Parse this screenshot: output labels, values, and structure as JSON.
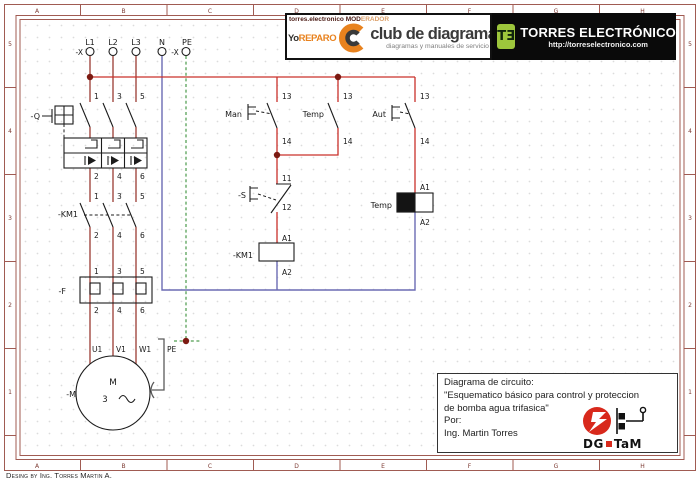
{
  "colors": {
    "phase_wire": "#9a3b33",
    "control_wire": "#c9312b",
    "neutral_wire": "#6b6bb4",
    "pe_wire": "#6fae6f",
    "junction_dot": "#7c1a12",
    "symbol_ink": "#1c1c1c",
    "frame_line": "#a05b52",
    "ruler_text": "#7d3b33",
    "grid_dot": "#d8d8d8",
    "brand_orange": "#e8821e",
    "logo_green": "#9dc63c",
    "logo_red": "#d8291c"
  },
  "ruler": {
    "cols": [
      "A",
      "B",
      "C",
      "D",
      "E",
      "F",
      "G",
      "H"
    ],
    "rows": [
      "5",
      "4",
      "3",
      "2",
      "1"
    ]
  },
  "header": {
    "left": {
      "line1_dark": "torres.electronico MOD",
      "line1_light": "ERADOR",
      "brand_dark": "Yo",
      "brand_orange": "REPARO",
      "title": "club de diagramas",
      "subtitle": "diagramas y manuales de servicio"
    },
    "right": {
      "logo": "TƎ",
      "title": "TORRES ELECTRÓNICO",
      "url": "http://torreselectronico.com"
    }
  },
  "title_block": {
    "lines": [
      "Diagrama de circuito:",
      "\"Esquematico básico para control y proteccion",
      "de bomba agua trifasica\"",
      "Por:",
      "Ing. Martin Torres"
    ],
    "logo_text_1": "DG",
    "logo_text_2": "TaM"
  },
  "footer": {
    "credit": "Desing by Ing. Torres Martin A."
  },
  "schematic": {
    "labels": [
      {
        "t": "L1",
        "x": 90,
        "y": 45,
        "a": "m",
        "s": 8
      },
      {
        "t": "L2",
        "x": 113,
        "y": 45,
        "a": "m",
        "s": 8
      },
      {
        "t": "L3",
        "x": 136,
        "y": 45,
        "a": "m",
        "s": 8
      },
      {
        "t": "N",
        "x": 162,
        "y": 45,
        "a": "m",
        "s": 8
      },
      {
        "t": "PE",
        "x": 187,
        "y": 45,
        "a": "m",
        "s": 8
      },
      {
        "t": "-X",
        "x": 83,
        "y": 55,
        "a": "e",
        "s": 7.5
      },
      {
        "t": "-X",
        "x": 175,
        "y": 55,
        "a": "m",
        "s": 7.5
      },
      {
        "t": "-Q",
        "x": 40,
        "y": 119,
        "a": "e",
        "s": 8
      },
      {
        "t": "1",
        "x": 94,
        "y": 99,
        "a": "s",
        "s": 7.5
      },
      {
        "t": "3",
        "x": 117,
        "y": 99,
        "a": "s",
        "s": 7.5
      },
      {
        "t": "5",
        "x": 140,
        "y": 99,
        "a": "s",
        "s": 7.5
      },
      {
        "t": "2",
        "x": 94,
        "y": 179,
        "a": "s",
        "s": 7.5
      },
      {
        "t": "4",
        "x": 117,
        "y": 179,
        "a": "s",
        "s": 7.5
      },
      {
        "t": "6",
        "x": 140,
        "y": 179,
        "a": "s",
        "s": 7.5
      },
      {
        "t": "1",
        "x": 94,
        "y": 199,
        "a": "s",
        "s": 7.5
      },
      {
        "t": "3",
        "x": 117,
        "y": 199,
        "a": "s",
        "s": 7.5
      },
      {
        "t": "5",
        "x": 140,
        "y": 199,
        "a": "s",
        "s": 7.5
      },
      {
        "t": "-KM1",
        "x": 78,
        "y": 217,
        "a": "e",
        "s": 8
      },
      {
        "t": "2",
        "x": 94,
        "y": 238,
        "a": "s",
        "s": 7.5
      },
      {
        "t": "4",
        "x": 117,
        "y": 238,
        "a": "s",
        "s": 7.5
      },
      {
        "t": "6",
        "x": 140,
        "y": 238,
        "a": "s",
        "s": 7.5
      },
      {
        "t": "1",
        "x": 94,
        "y": 274,
        "a": "s",
        "s": 7.5
      },
      {
        "t": "3",
        "x": 117,
        "y": 274,
        "a": "s",
        "s": 7.5
      },
      {
        "t": "5",
        "x": 140,
        "y": 274,
        "a": "s",
        "s": 7.5
      },
      {
        "t": "-F",
        "x": 66,
        "y": 294,
        "a": "e",
        "s": 8
      },
      {
        "t": "2",
        "x": 94,
        "y": 313,
        "a": "s",
        "s": 7.5
      },
      {
        "t": "4",
        "x": 117,
        "y": 313,
        "a": "s",
        "s": 7.5
      },
      {
        "t": "6",
        "x": 140,
        "y": 313,
        "a": "s",
        "s": 7.5
      },
      {
        "t": "U1",
        "x": 92,
        "y": 352,
        "a": "s",
        "s": 7.5
      },
      {
        "t": "V1",
        "x": 116,
        "y": 352,
        "a": "s",
        "s": 7.5
      },
      {
        "t": "W1",
        "x": 139,
        "y": 352,
        "a": "s",
        "s": 7.5
      },
      {
        "t": "PE",
        "x": 167,
        "y": 352,
        "a": "s",
        "s": 7.5
      },
      {
        "t": "-M",
        "x": 76,
        "y": 397,
        "a": "e",
        "s": 8
      },
      {
        "t": "M",
        "x": 113,
        "y": 385,
        "a": "m",
        "s": 9
      },
      {
        "t": "3",
        "x": 105,
        "y": 402,
        "a": "m",
        "s": 8.5
      },
      {
        "t": "Man",
        "x": 242,
        "y": 117,
        "a": "e",
        "s": 8
      },
      {
        "t": "Temp",
        "x": 324,
        "y": 117,
        "a": "e",
        "s": 8
      },
      {
        "t": "Aut",
        "x": 386,
        "y": 117,
        "a": "e",
        "s": 8
      },
      {
        "t": "13",
        "x": 282,
        "y": 99,
        "a": "s",
        "s": 7.5
      },
      {
        "t": "13",
        "x": 343,
        "y": 99,
        "a": "s",
        "s": 7.5
      },
      {
        "t": "13",
        "x": 420,
        "y": 99,
        "a": "s",
        "s": 7.5
      },
      {
        "t": "14",
        "x": 282,
        "y": 144,
        "a": "s",
        "s": 7.5
      },
      {
        "t": "14",
        "x": 343,
        "y": 144,
        "a": "s",
        "s": 7.5
      },
      {
        "t": "14",
        "x": 420,
        "y": 144,
        "a": "s",
        "s": 7.5
      },
      {
        "t": "11",
        "x": 282,
        "y": 181,
        "a": "s",
        "s": 7.5
      },
      {
        "t": "-S",
        "x": 246,
        "y": 198,
        "a": "e",
        "s": 8
      },
      {
        "t": "12",
        "x": 282,
        "y": 210,
        "a": "s",
        "s": 7.5
      },
      {
        "t": "A1",
        "x": 282,
        "y": 241,
        "a": "s",
        "s": 7.5
      },
      {
        "t": "-KM1",
        "x": 253,
        "y": 258,
        "a": "e",
        "s": 8
      },
      {
        "t": "A2",
        "x": 282,
        "y": 275,
        "a": "s",
        "s": 7.5
      },
      {
        "t": "A1",
        "x": 420,
        "y": 190,
        "a": "s",
        "s": 7.5
      },
      {
        "t": "Temp",
        "x": 392,
        "y": 208,
        "a": "e",
        "s": 8
      },
      {
        "t": "A2",
        "x": 420,
        "y": 225,
        "a": "s",
        "s": 7.5
      }
    ]
  }
}
